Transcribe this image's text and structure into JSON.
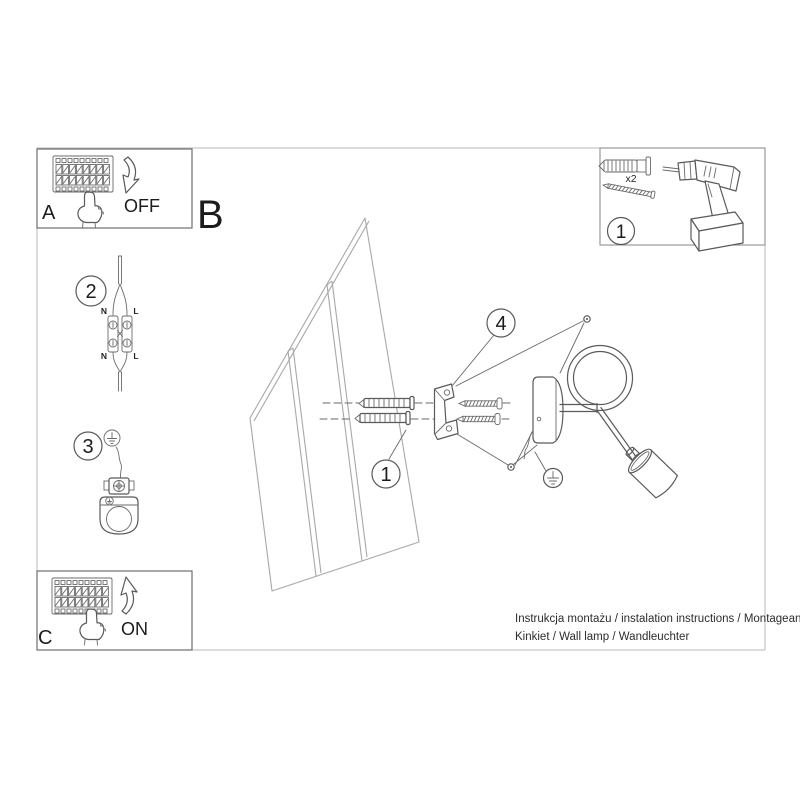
{
  "document": {
    "type": "installation-instruction-sheet",
    "product": "wall lamp"
  },
  "panels": {
    "power_off_box": {
      "label": "A",
      "action": "OFF"
    },
    "mounting_section": {
      "label": "B"
    },
    "power_on_box": {
      "label": "C",
      "action": "ON"
    }
  },
  "steps": {
    "tools_box": {
      "number": "1",
      "anchor_quantity": "x2"
    },
    "wall_anchor_pointer": {
      "number": "1"
    },
    "wiring": {
      "number": "2",
      "labels": {
        "top_left": "N",
        "top_right": "L",
        "bottom_left": "N",
        "bottom_right": "L"
      }
    },
    "grounding": {
      "number": "3"
    },
    "fixing_lamp": {
      "number": "4"
    }
  },
  "footer": {
    "line1": "Instrukcja montażu / instalation instructions / Montageanleitung",
    "line2": "Kinkiet / Wall lamp / Wandleuchter"
  },
  "colors": {
    "line": "#5a5a5a",
    "wall_line": "#a8a8a8",
    "frame": "#b9b9b9",
    "text": "#1c1c1c",
    "background": "#ffffff"
  }
}
